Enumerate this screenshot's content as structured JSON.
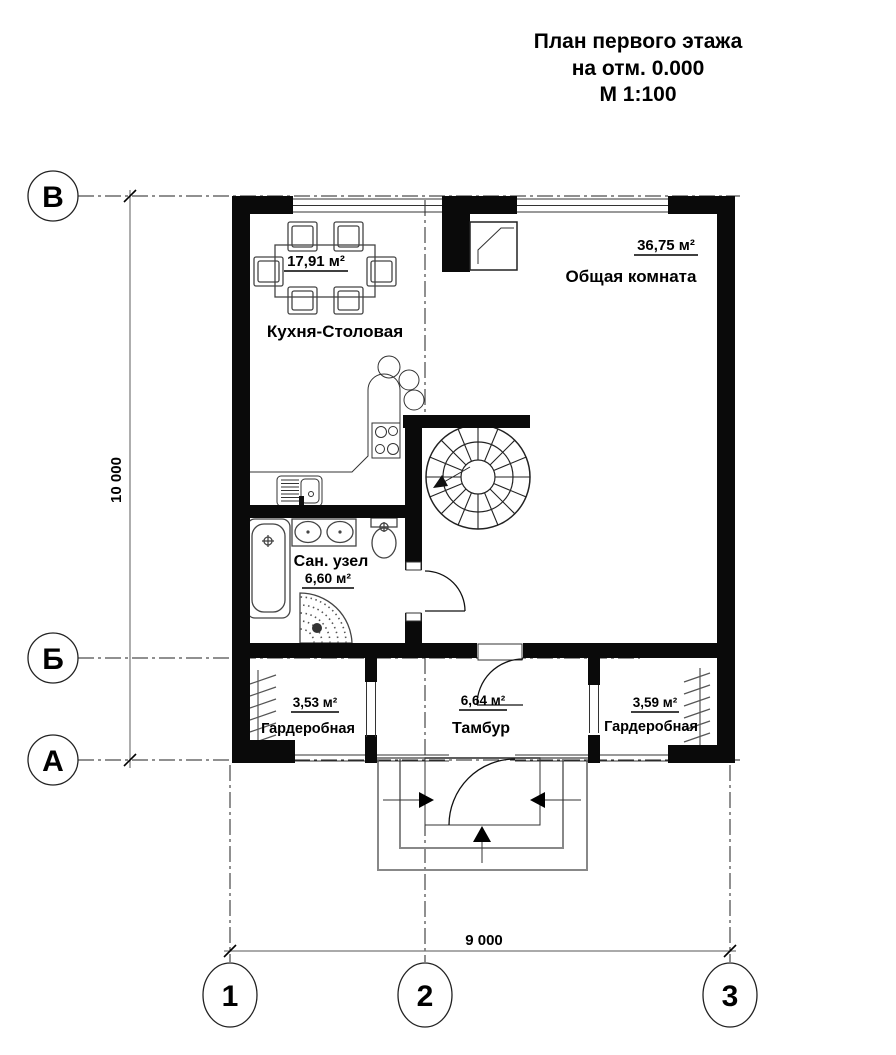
{
  "title": {
    "line1": "План первого этажа",
    "line2": "на отм. 0.000",
    "line3": "М 1:100"
  },
  "rooms": {
    "kitchen": {
      "name": "Кухня-Столовая",
      "area": "17,91 м²"
    },
    "living": {
      "name": "Общая комната",
      "area": "36,75 м²"
    },
    "bathroom": {
      "name": "Сан. узел",
      "area": "6,60 м²"
    },
    "wardrobe_left": {
      "name": "Гардеробная",
      "area": "3,53 м²"
    },
    "tambour": {
      "name": "Тамбур",
      "area": "6,64 м²"
    },
    "wardrobe_right": {
      "name": "Гардеробная",
      "area": "3,59 м²"
    }
  },
  "grid_axes": {
    "row_top": "В",
    "row_mid": "Б",
    "row_bottom": "А",
    "col_left": "1",
    "col_mid": "2",
    "col_right": "3"
  },
  "dimensions": {
    "height_total": "10 000",
    "width_total": "9 000"
  },
  "colors": {
    "wall": "#0a0a0a",
    "furniture_line": "#444444",
    "grid_line": "#222222",
    "dimension_line": "#777777",
    "background": "#ffffff"
  }
}
